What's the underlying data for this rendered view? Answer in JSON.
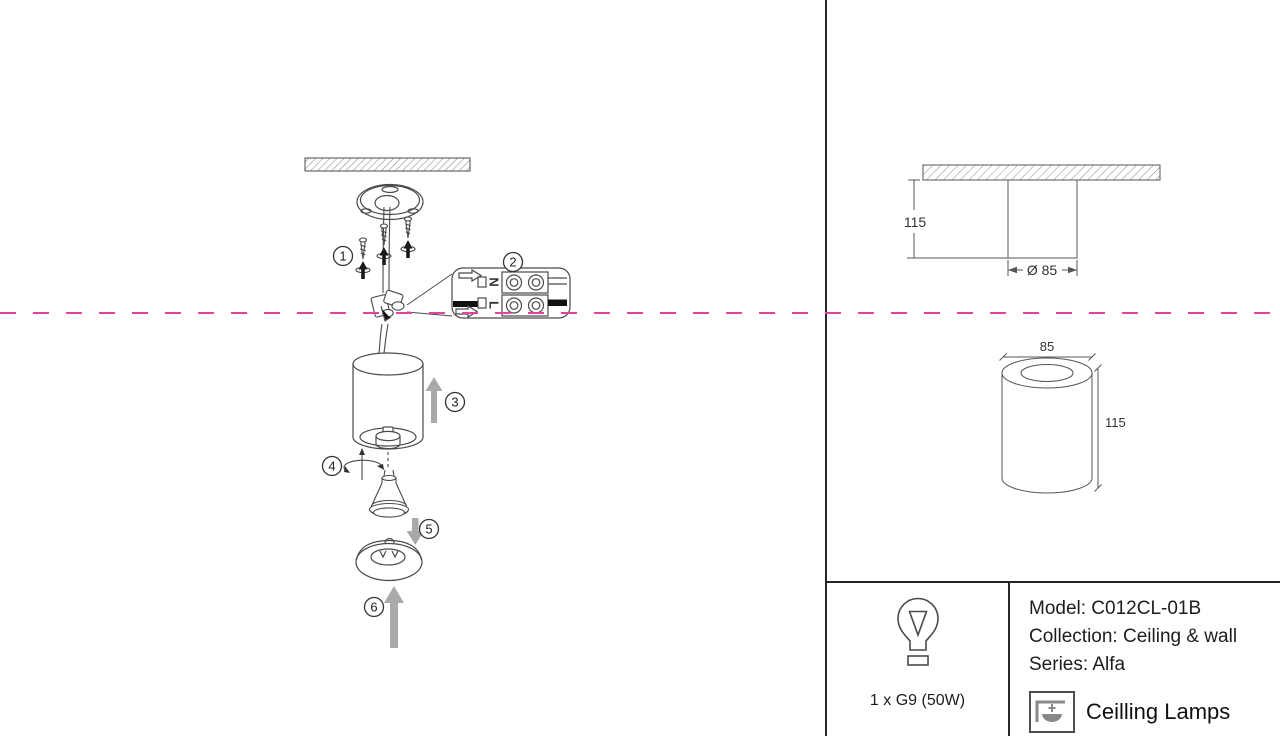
{
  "colors": {
    "fold_line": "#e5439a",
    "line_art": "#4a4a4a",
    "arrow_gray": "#a9a9a9"
  },
  "installation": {
    "steps": [
      "1",
      "2",
      "3",
      "4",
      "5",
      "6"
    ],
    "terminal": {
      "neutral": "N",
      "live": "L"
    }
  },
  "dimensions": {
    "side_view": {
      "height": "115",
      "diameter": "Ø 85"
    },
    "perspective_view": {
      "diameter": "85",
      "height": "115"
    }
  },
  "info": {
    "lamp_spec": "1 x G9 (50W)",
    "model": "Model: C012CL-01B",
    "collection": "Collection: Ceiling & wall",
    "series": "Series: Alfa",
    "category": "Ceilling Lamps"
  }
}
